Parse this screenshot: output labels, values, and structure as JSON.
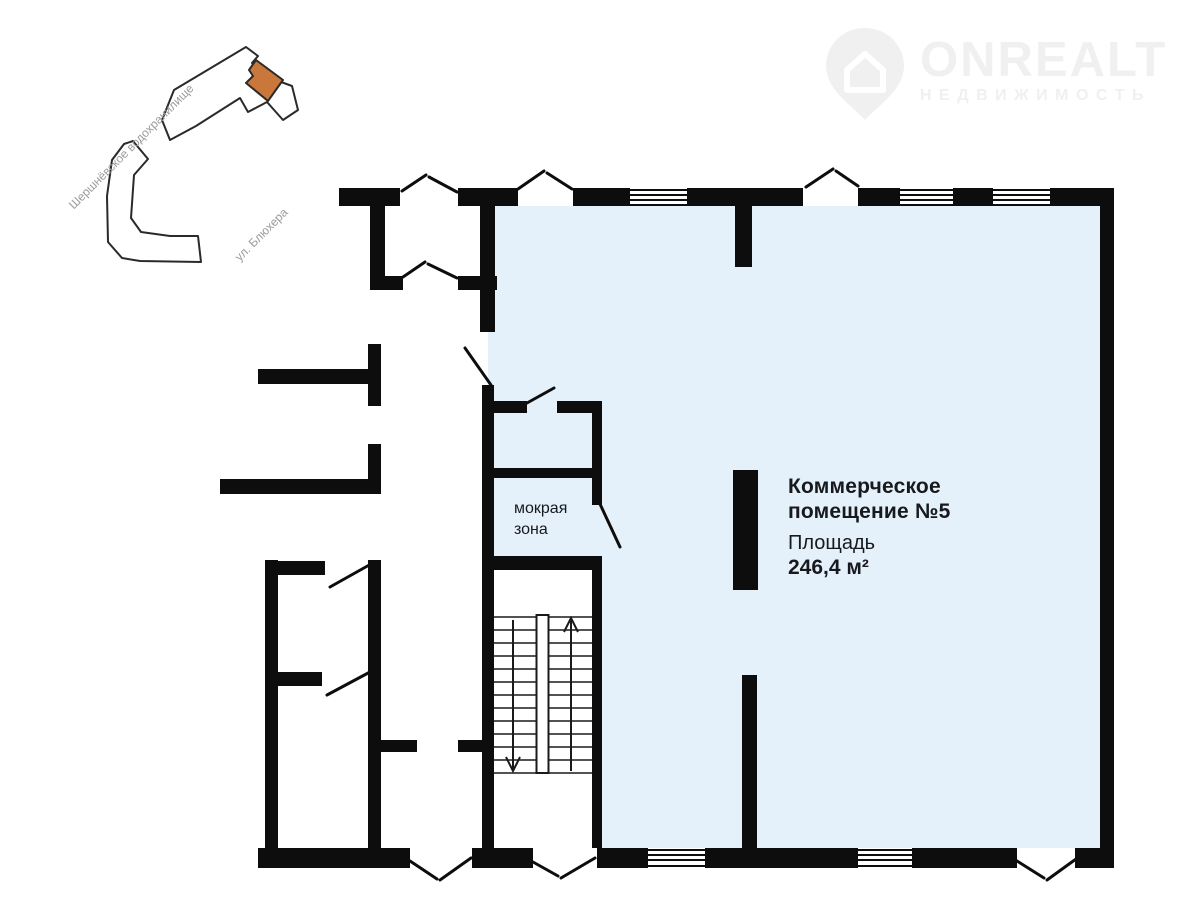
{
  "logo": {
    "brand": "ONREALT",
    "subtitle": "НЕДВИЖИМОСТЬ",
    "color": "#f0f0f0"
  },
  "map_inset": {
    "water_label": "Шершнёвское водохранилище",
    "street_label": "ул. Блюхера",
    "highlight_color": "#c9773b",
    "outline_color": "#2a2a2a",
    "label_color": "#9b9b9b"
  },
  "floor_plan": {
    "title_line1": "Коммерческое",
    "title_line2": "помещение №5",
    "area_label": "Площадь",
    "area_value": "246,4 м²",
    "wet_zone_line1": "мокрая",
    "wet_zone_line2": "зона",
    "unit_fill": "#e4f1fb",
    "wall_color": "#0d0d0d"
  }
}
